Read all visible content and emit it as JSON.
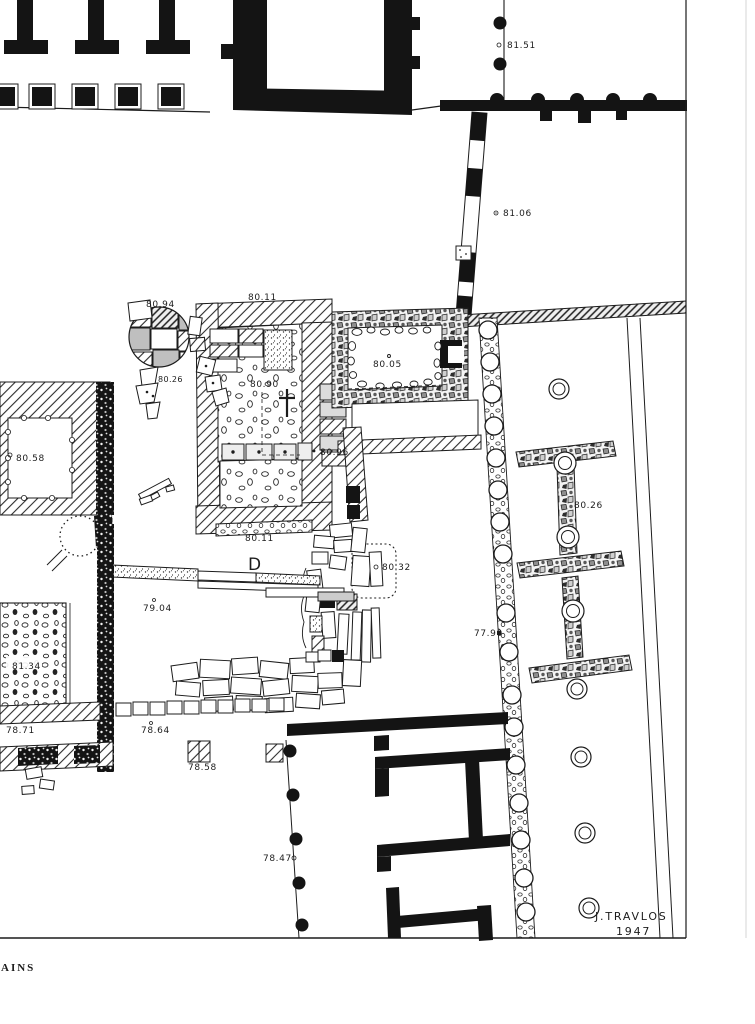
{
  "document": {
    "area_letter": "D",
    "credit_name": "J.TRAVLOS",
    "credit_year": "1947",
    "caption_fragment": "AINS"
  },
  "elevations": {
    "e81_51": "81.51",
    "e81_06": "81.06",
    "e80_94": "80.94",
    "e80_11_top": "80.11",
    "e80_05": "80.05",
    "e80_58": "80.58",
    "e80_90": "80.90",
    "e80_26_left": "80.26",
    "e80_96": "80.96",
    "e80_11_bottom": "80.11",
    "e80_32": "80.32",
    "e79_04": "79.04",
    "e81_34": "81.34",
    "e78_71": "78.71",
    "e78_64": "78.64",
    "e78_58": "78.58",
    "e77_90": "77.90",
    "e80_26_right": "80.26",
    "e78_47": "78.47"
  },
  "colors": {
    "ink": "#1c1c1c",
    "paper": "#ffffff"
  }
}
